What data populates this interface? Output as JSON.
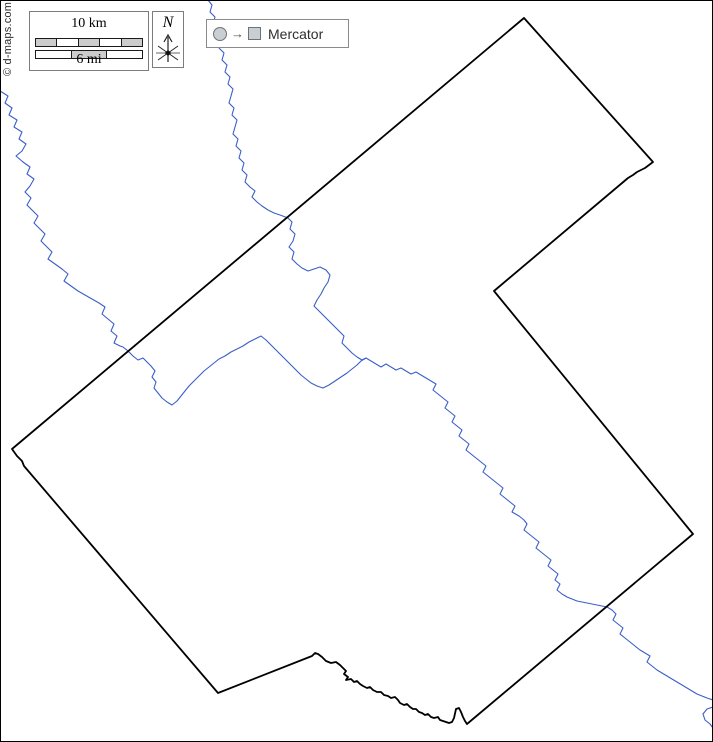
{
  "page": {
    "width": 713,
    "height": 742,
    "background": "#ffffff",
    "frame_color": "#000000"
  },
  "scalebar": {
    "km_label": "10 km",
    "mi_label": "6 mi",
    "segment_fill": "#cccccc",
    "km_pattern": [
      "fill",
      "none",
      "fill",
      "none",
      "fill"
    ],
    "mi_pattern": [
      "none",
      "fill",
      "none"
    ]
  },
  "compass": {
    "label": "N"
  },
  "projection": {
    "label": "Mercator",
    "arrow_glyph": "→"
  },
  "credit": {
    "text": "© d-maps.com"
  },
  "map": {
    "boundary_color": "#000000",
    "boundary_width": 1.8,
    "river_color": "#3a5ec9",
    "river_width": 1.1,
    "boundary_points": [
      [
        524,
        18
      ],
      [
        12,
        449
      ],
      [
        17,
        456
      ],
      [
        22,
        461
      ],
      [
        24,
        466
      ],
      [
        218,
        693
      ],
      [
        312,
        656
      ],
      [
        315,
        653
      ],
      [
        318,
        654
      ],
      [
        322,
        657
      ],
      [
        326,
        661
      ],
      [
        331,
        663
      ],
      [
        336,
        662
      ],
      [
        340,
        665
      ],
      [
        343,
        668
      ],
      [
        346,
        671
      ],
      [
        344,
        674
      ],
      [
        348,
        677
      ],
      [
        346,
        680
      ],
      [
        351,
        679
      ],
      [
        354,
        682
      ],
      [
        357,
        681
      ],
      [
        360,
        684
      ],
      [
        363,
        686
      ],
      [
        367,
        688
      ],
      [
        370,
        687
      ],
      [
        373,
        690
      ],
      [
        377,
        692
      ],
      [
        381,
        692
      ],
      [
        384,
        695
      ],
      [
        388,
        696
      ],
      [
        391,
        698
      ],
      [
        395,
        697
      ],
      [
        398,
        700
      ],
      [
        400,
        703
      ],
      [
        404,
        705
      ],
      [
        407,
        704
      ],
      [
        410,
        707
      ],
      [
        413,
        709
      ],
      [
        416,
        709
      ],
      [
        419,
        712
      ],
      [
        422,
        713
      ],
      [
        425,
        715
      ],
      [
        428,
        714
      ],
      [
        431,
        717
      ],
      [
        434,
        718
      ],
      [
        438,
        717
      ],
      [
        440,
        720
      ],
      [
        443,
        721
      ],
      [
        446,
        722
      ],
      [
        449,
        723
      ],
      [
        452,
        722
      ],
      [
        454,
        718
      ],
      [
        456,
        709
      ],
      [
        459,
        708
      ],
      [
        461,
        712
      ],
      [
        463,
        717
      ],
      [
        465,
        721
      ],
      [
        467,
        724
      ],
      [
        693,
        534
      ],
      [
        494,
        291
      ],
      [
        628,
        178
      ],
      [
        633,
        175
      ],
      [
        637,
        172
      ],
      [
        645,
        168
      ],
      [
        653,
        162
      ]
    ],
    "rivers": [
      [
        [
          0,
          91
        ],
        [
          8,
          96
        ],
        [
          5,
          103
        ],
        [
          12,
          108
        ],
        [
          9,
          115
        ],
        [
          17,
          120
        ],
        [
          14,
          127
        ],
        [
          22,
          132
        ],
        [
          19,
          139
        ],
        [
          26,
          144
        ],
        [
          22,
          151
        ],
        [
          16,
          156
        ],
        [
          23,
          162
        ],
        [
          30,
          167
        ],
        [
          27,
          174
        ],
        [
          34,
          179
        ],
        [
          30,
          186
        ],
        [
          25,
          192
        ],
        [
          31,
          198
        ],
        [
          27,
          205
        ],
        [
          33,
          211
        ],
        [
          38,
          216
        ],
        [
          34,
          223
        ],
        [
          40,
          229
        ],
        [
          45,
          234
        ],
        [
          41,
          241
        ],
        [
          47,
          247
        ],
        [
          52,
          252
        ],
        [
          48,
          259
        ],
        [
          55,
          264
        ],
        [
          62,
          269
        ],
        [
          68,
          274
        ],
        [
          64,
          281
        ],
        [
          71,
          286
        ],
        [
          78,
          291
        ],
        [
          85,
          295
        ],
        [
          92,
          299
        ],
        [
          99,
          303
        ],
        [
          105,
          307
        ],
        [
          102,
          314
        ],
        [
          108,
          319
        ],
        [
          114,
          324
        ],
        [
          111,
          331
        ],
        [
          117,
          336
        ],
        [
          114,
          343
        ],
        [
          120,
          346
        ],
        [
          123,
          347
        ],
        [
          128,
          351
        ],
        [
          133,
          356
        ],
        [
          138,
          360
        ],
        [
          143,
          358
        ],
        [
          147,
          362
        ],
        [
          151,
          366
        ],
        [
          155,
          371
        ],
        [
          152,
          377
        ],
        [
          156,
          382
        ],
        [
          154,
          388
        ],
        [
          158,
          393
        ],
        [
          162,
          398
        ],
        [
          167,
          402
        ],
        [
          172,
          405
        ],
        [
          177,
          401
        ],
        [
          181,
          396
        ],
        [
          185,
          391
        ],
        [
          189,
          386
        ],
        [
          194,
          381
        ],
        [
          199,
          376
        ],
        [
          204,
          371
        ],
        [
          209,
          367
        ],
        [
          214,
          363
        ],
        [
          219,
          359
        ],
        [
          225,
          356
        ],
        [
          231,
          352
        ],
        [
          237,
          349
        ],
        [
          243,
          346
        ],
        [
          249,
          342
        ],
        [
          255,
          339
        ],
        [
          261,
          336
        ],
        [
          266,
          340
        ],
        [
          271,
          345
        ],
        [
          276,
          350
        ],
        [
          281,
          355
        ],
        [
          286,
          360
        ],
        [
          291,
          365
        ],
        [
          296,
          370
        ],
        [
          301,
          375
        ],
        [
          306,
          379
        ],
        [
          311,
          383
        ],
        [
          317,
          386
        ],
        [
          323,
          388
        ],
        [
          329,
          385
        ],
        [
          335,
          381
        ],
        [
          341,
          377
        ],
        [
          347,
          373
        ],
        [
          352,
          369
        ],
        [
          357,
          365
        ],
        [
          361,
          361
        ],
        [
          366,
          358
        ],
        [
          371,
          361
        ],
        [
          376,
          364
        ],
        [
          381,
          367
        ],
        [
          386,
          364
        ],
        [
          391,
          367
        ],
        [
          396,
          370
        ],
        [
          401,
          368
        ],
        [
          406,
          371
        ],
        [
          411,
          374
        ],
        [
          416,
          372
        ],
        [
          421,
          375
        ],
        [
          426,
          378
        ],
        [
          431,
          381
        ],
        [
          436,
          384
        ],
        [
          433,
          390
        ],
        [
          438,
          394
        ],
        [
          443,
          398
        ],
        [
          448,
          402
        ],
        [
          445,
          408
        ],
        [
          450,
          412
        ],
        [
          455,
          416
        ],
        [
          452,
          422
        ],
        [
          457,
          426
        ],
        [
          462,
          430
        ],
        [
          459,
          436
        ],
        [
          464,
          440
        ],
        [
          469,
          444
        ],
        [
          466,
          450
        ],
        [
          471,
          454
        ],
        [
          476,
          458
        ],
        [
          481,
          462
        ],
        [
          486,
          466
        ],
        [
          483,
          472
        ],
        [
          488,
          476
        ],
        [
          493,
          480
        ],
        [
          498,
          484
        ],
        [
          503,
          488
        ],
        [
          500,
          494
        ],
        [
          505,
          498
        ],
        [
          510,
          502
        ],
        [
          515,
          506
        ],
        [
          512,
          512
        ],
        [
          519,
          516
        ],
        [
          524,
          520
        ],
        [
          527,
          524
        ],
        [
          524,
          530
        ],
        [
          529,
          534
        ],
        [
          534,
          538
        ],
        [
          539,
          542
        ],
        [
          536,
          548
        ],
        [
          541,
          552
        ],
        [
          546,
          556
        ],
        [
          551,
          560
        ],
        [
          548,
          566
        ],
        [
          553,
          570
        ],
        [
          558,
          574
        ],
        [
          555,
          580
        ],
        [
          560,
          584
        ],
        [
          557,
          590
        ],
        [
          562,
          594
        ],
        [
          567,
          597
        ],
        [
          572,
          599
        ],
        [
          577,
          601
        ],
        [
          582,
          602
        ],
        [
          587,
          603
        ],
        [
          592,
          604
        ],
        [
          597,
          605
        ],
        [
          602,
          606
        ],
        [
          607,
          607
        ],
        [
          612,
          610
        ],
        [
          616,
          614
        ],
        [
          613,
          620
        ],
        [
          618,
          624
        ],
        [
          623,
          628
        ],
        [
          620,
          634
        ],
        [
          625,
          638
        ],
        [
          630,
          642
        ],
        [
          635,
          646
        ],
        [
          640,
          650
        ],
        [
          645,
          653
        ],
        [
          650,
          656
        ],
        [
          647,
          662
        ],
        [
          652,
          666
        ],
        [
          657,
          670
        ],
        [
          662,
          673
        ],
        [
          667,
          676
        ],
        [
          672,
          679
        ],
        [
          677,
          682
        ],
        [
          682,
          685
        ],
        [
          687,
          688
        ],
        [
          692,
          691
        ],
        [
          697,
          694
        ],
        [
          702,
          696
        ],
        [
          707,
          698
        ],
        [
          713,
          700
        ]
      ],
      [
        [
          713,
          707
        ],
        [
          707,
          709
        ],
        [
          703,
          714
        ],
        [
          705,
          720
        ],
        [
          710,
          724
        ],
        [
          713,
          728
        ]
      ],
      [
        [
          208,
          0
        ],
        [
          212,
          5
        ],
        [
          210,
          12
        ],
        [
          215,
          17
        ],
        [
          213,
          24
        ],
        [
          218,
          29
        ],
        [
          216,
          36
        ],
        [
          221,
          41
        ],
        [
          219,
          48
        ],
        [
          224,
          53
        ],
        [
          222,
          60
        ],
        [
          227,
          65
        ],
        [
          225,
          72
        ],
        [
          230,
          77
        ],
        [
          228,
          84
        ],
        [
          233,
          89
        ],
        [
          231,
          96
        ],
        [
          229,
          103
        ],
        [
          234,
          108
        ],
        [
          232,
          115
        ],
        [
          237,
          120
        ],
        [
          235,
          127
        ],
        [
          233,
          134
        ],
        [
          238,
          139
        ],
        [
          236,
          146
        ],
        [
          241,
          151
        ],
        [
          239,
          158
        ],
        [
          244,
          163
        ],
        [
          242,
          170
        ],
        [
          247,
          175
        ],
        [
          245,
          182
        ],
        [
          250,
          187
        ],
        [
          255,
          191
        ],
        [
          252,
          197
        ],
        [
          257,
          202
        ],
        [
          262,
          206
        ],
        [
          268,
          210
        ],
        [
          274,
          213
        ],
        [
          280,
          215
        ],
        [
          288,
          218
        ],
        [
          292,
          222
        ],
        [
          290,
          229
        ],
        [
          295,
          234
        ],
        [
          293,
          241
        ],
        [
          289,
          247
        ],
        [
          294,
          252
        ],
        [
          292,
          259
        ],
        [
          297,
          264
        ],
        [
          302,
          268
        ],
        [
          308,
          271
        ],
        [
          314,
          269
        ],
        [
          320,
          267
        ],
        [
          326,
          270
        ],
        [
          330,
          275
        ],
        [
          328,
          282
        ],
        [
          324,
          288
        ],
        [
          321,
          294
        ],
        [
          317,
          300
        ],
        [
          314,
          306
        ],
        [
          319,
          311
        ],
        [
          324,
          316
        ],
        [
          329,
          321
        ],
        [
          334,
          326
        ],
        [
          339,
          331
        ],
        [
          344,
          336
        ],
        [
          342,
          343
        ],
        [
          347,
          348
        ],
        [
          352,
          353
        ],
        [
          357,
          357
        ],
        [
          362,
          360
        ],
        [
          366,
          358
        ]
      ]
    ]
  }
}
